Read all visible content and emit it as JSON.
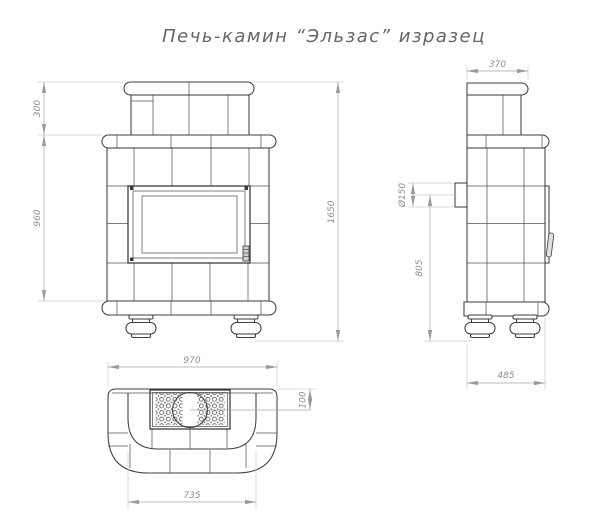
{
  "title": "Печь-камин “Эльзас” изразец",
  "colors": {
    "background": "#ffffff",
    "outline": "#3f3f3f",
    "tile_joint": "#555555",
    "dimension_line": "#a6a6a6",
    "dimension_text": "#8d8d8d",
    "title_text": "#666666"
  },
  "front_view": {
    "dims": {
      "chimney_height": "300",
      "body_height": "960",
      "total_height": "1650"
    }
  },
  "side_view": {
    "dims": {
      "top_depth": "370",
      "flue_diameter": "Ø150",
      "flue_center_height": "805",
      "base_depth": "485"
    }
  },
  "plan_view": {
    "dims": {
      "overall_width": "970",
      "flue_offset": "100",
      "inner_width": "735"
    }
  }
}
